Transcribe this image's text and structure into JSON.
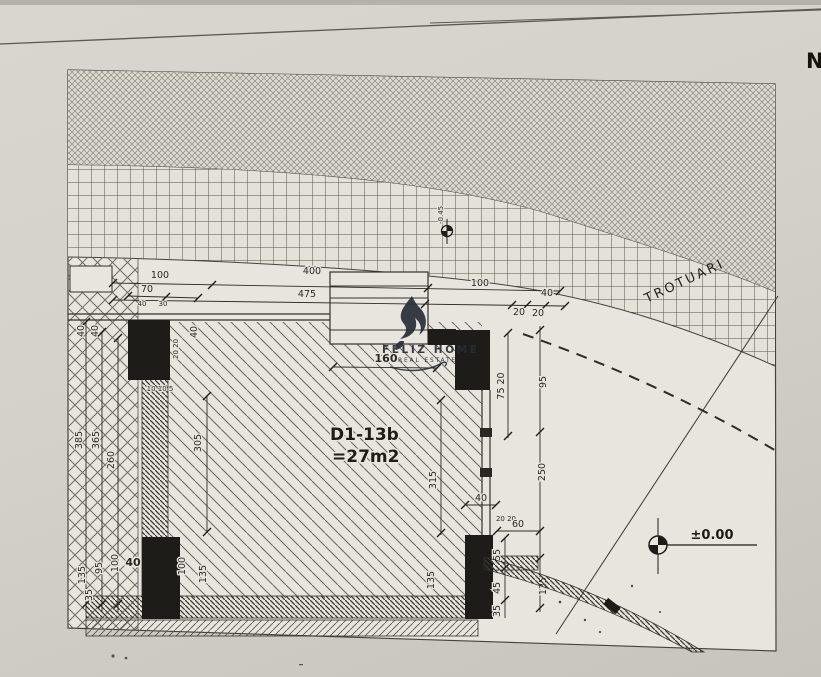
{
  "meta": {
    "description": "Scanned architectural site plan detail of unit D1-13b"
  },
  "plan": {
    "room": {
      "id": "D1-13b",
      "area": "=27m2"
    },
    "sidewalk_label": "TROTUARI",
    "levels": {
      "main": "±0.00",
      "sidewalk": "-0.45"
    },
    "corner_letter": "N"
  },
  "watermark": {
    "title": "FELIZ HOME",
    "subtitle": "REAL ESTATE"
  },
  "dims": {
    "t100a": "100",
    "t400": "400",
    "t100b": "100",
    "t70": "70",
    "t40s": "40",
    "t30s": "30",
    "t475": "475",
    "t40a": "40",
    "t20a": "20",
    "t20b": "20",
    "t160": "160",
    "r7520": "75 20",
    "r95": "95",
    "r250": "250",
    "r315": "315",
    "r135a": "135",
    "r40": "40",
    "r2020": "20 20",
    "r60": "60",
    "r55": "55",
    "r45": "45",
    "r35": "35",
    "r135b": "135",
    "l40a": "40",
    "l40b": "40",
    "l40c": "40",
    "l2020": "20 20",
    "l385": "385",
    "l365": "365",
    "l260": "260",
    "l305": "305",
    "l10105": "10 10 5",
    "b135a": "135",
    "b95": "95",
    "b100a": "100",
    "b40": "40",
    "b100b": "100",
    "b135b": "135",
    "b35": "35"
  }
}
